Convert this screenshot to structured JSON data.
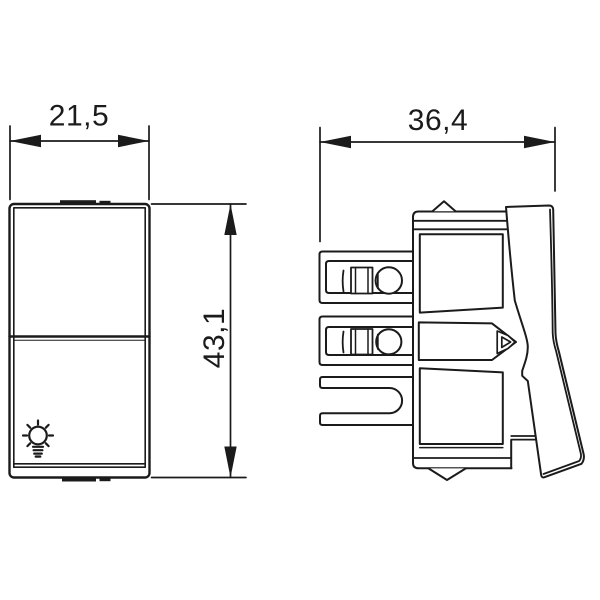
{
  "page": {
    "background_color": "#ffffff",
    "line_color": "#1b1b1b"
  },
  "drawing": {
    "views": {
      "front": {
        "width_dimension": "21,5",
        "height_dimension": "43,1",
        "icon": "lamp-icon"
      },
      "side": {
        "depth_dimension": "36,4"
      }
    }
  }
}
